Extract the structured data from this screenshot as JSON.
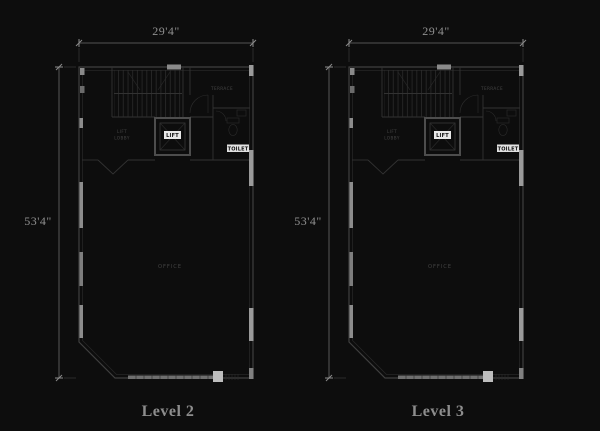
{
  "background": "#0d0d0d",
  "plan_labels": {
    "lift": "LIFT",
    "toilet": "TOILET",
    "lobby_line1": "LIFT",
    "lobby_line2": "LOBBY",
    "office": "OFFICE",
    "upper_room": "TERRACE"
  },
  "figures": [
    {
      "width_dim": "29'4\"",
      "height_dim": "53'4\"",
      "level": "Level 2"
    },
    {
      "width_dim": "29'4\"",
      "height_dim": "53'4\"",
      "level": "Level 3"
    }
  ],
  "colors": {
    "background": "#0d0d0d",
    "wall_line": "#3f3f3f",
    "dimension_text": "#8f8f8f",
    "window_strip": "#8c8c8c",
    "column_block": "#9a9a9a",
    "label_box": "#e8e8e8"
  }
}
